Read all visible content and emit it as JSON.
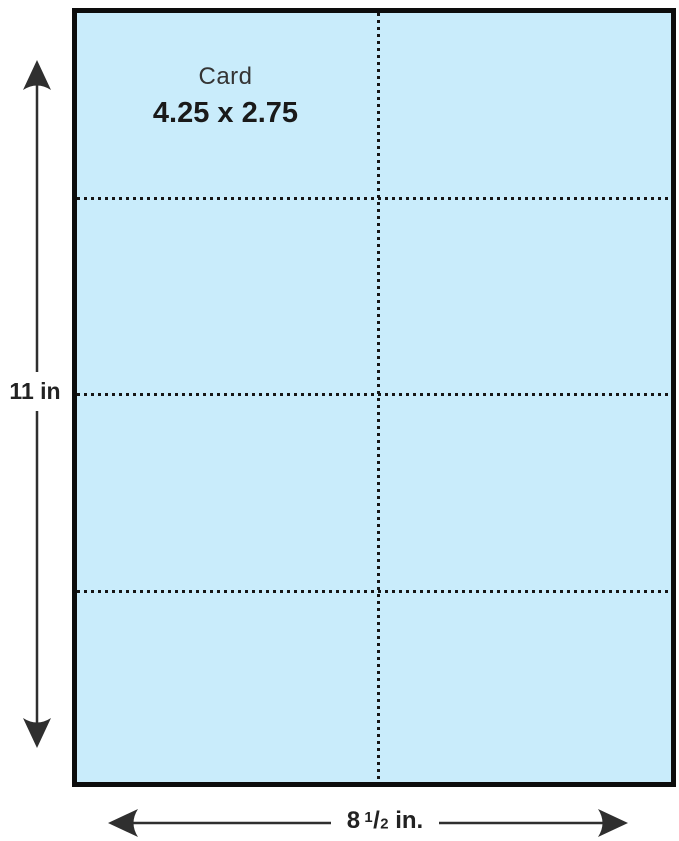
{
  "sheet": {
    "fill_color": "#c9ecfb",
    "border_color": "#0d0d0d",
    "rows": 4,
    "columns": 2,
    "card": {
      "label": "Card",
      "size": "4.25 x 2.75"
    }
  },
  "dimensions": {
    "height": {
      "label": "11 in"
    },
    "width": {
      "whole": "8",
      "fraction_numerator": "1",
      "fraction_slash": "/",
      "fraction_denominator": "2",
      "unit": "in."
    }
  },
  "colors": {
    "arrow": "#2f2f2f",
    "perforation_line": "#151515",
    "text": "#222222"
  }
}
